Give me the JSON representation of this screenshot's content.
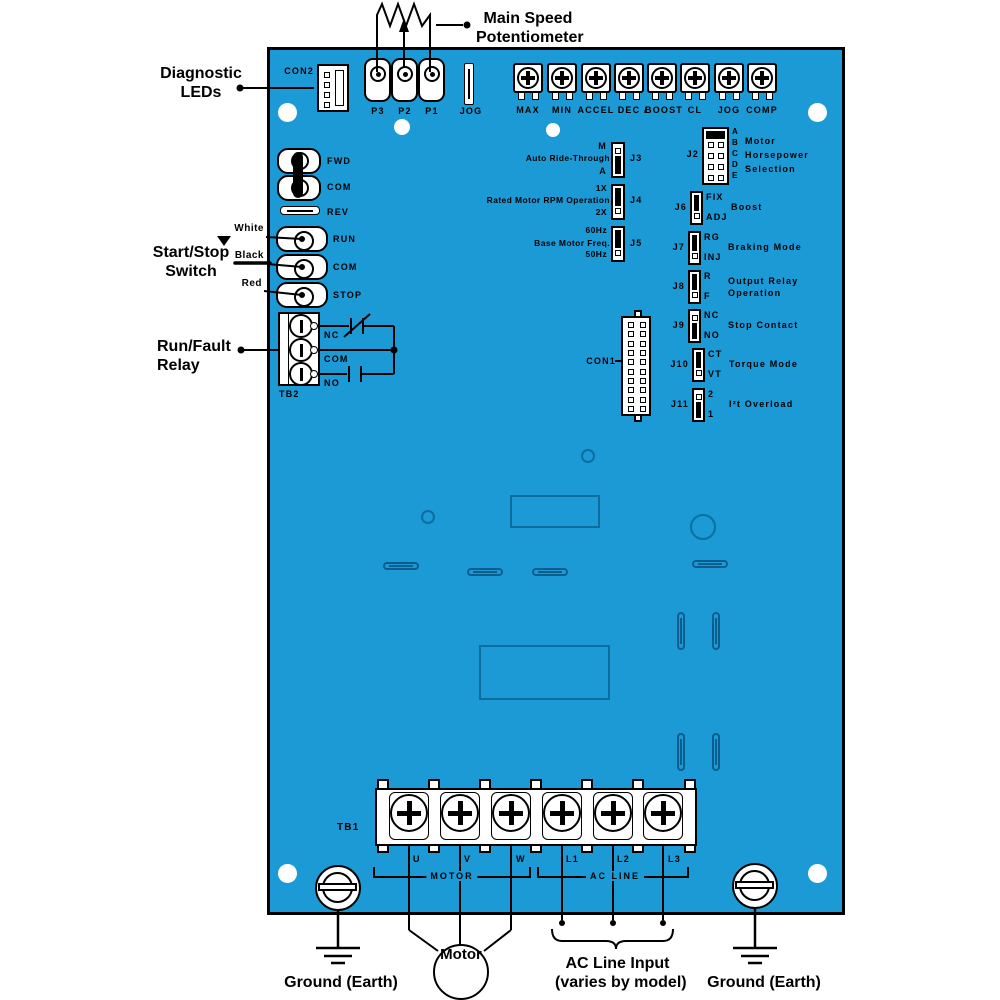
{
  "colors": {
    "board_blue": "#1b9ad6",
    "outline_blue": "#0d6e9e",
    "black": "#000000",
    "white": "#ffffff"
  },
  "callouts": {
    "main_speed_pot": {
      "line1": "Main Speed",
      "line2": "Potentiometer"
    },
    "diagnostic_leds": {
      "line1": "Diagnostic",
      "line2": "LEDs"
    },
    "start_stop_switch": {
      "line1": "Start/Stop",
      "line2": "Switch"
    },
    "run_fault_relay": {
      "line1": "Run/Fault",
      "line2": "Relay"
    },
    "ground_left": "Ground (Earth)",
    "ground_right": "Ground (Earth)",
    "motor": "Motor",
    "ac_line_input": {
      "line1": "AC Line Input",
      "line2": "(varies by model)"
    },
    "wire_white": "White",
    "wire_black": "Black",
    "wire_red": "Red"
  },
  "connectors": {
    "con1": "CON1",
    "con2": "CON2"
  },
  "speed_pot_terminals": {
    "p3": "P3",
    "p2": "P2",
    "p1": "P1",
    "jog": "JOG"
  },
  "trim_pots": {
    "labels": [
      "MAX",
      "MIN",
      "ACCEL",
      "DEC",
      "BOOST",
      "CL",
      "JOG",
      "COMP"
    ],
    "separator": "/"
  },
  "direction_switch": {
    "fwd": "FWD",
    "com": "COM",
    "rev": "REV"
  },
  "start_stop_terminals": {
    "run": "RUN",
    "com": "COM",
    "stop": "STOP"
  },
  "tb2": {
    "name": "TB2",
    "nc": "NC",
    "com": "COM",
    "no": "NO"
  },
  "jumpers": {
    "j3": {
      "id": "J3",
      "label": "Auto Ride-Through",
      "top": "M",
      "bottom": "A",
      "selected": "A"
    },
    "j4": {
      "id": "J4",
      "label": "Rated Motor RPM Operation",
      "top": "1X",
      "bottom": "2X",
      "selected": "1X"
    },
    "j5": {
      "id": "J5",
      "label": "Base Motor Freq.",
      "top": "60Hz",
      "bottom": "50Hz",
      "selected": "60Hz"
    },
    "j2": {
      "id": "J2",
      "pins": [
        "A",
        "B",
        "C",
        "D",
        "E"
      ],
      "label_line1": "Motor",
      "label_line2": "Horsepower",
      "label_line3": "Selection",
      "selected": "A"
    },
    "j6": {
      "id": "J6",
      "top": "FIX",
      "bottom": "ADJ",
      "label": "Boost",
      "selected": "FIX"
    },
    "j7": {
      "id": "J7",
      "top": "RG",
      "bottom": "INJ",
      "label": "Braking Mode",
      "selected": "RG"
    },
    "j8": {
      "id": "J8",
      "top": "R",
      "bottom": "F",
      "label_line1": "Output Relay",
      "label_line2": "Operation",
      "selected": "R"
    },
    "j9": {
      "id": "J9",
      "top": "NC",
      "bottom": "NO",
      "label": "Stop Contact",
      "selected": "NO"
    },
    "j10": {
      "id": "J10",
      "top": "CT",
      "bottom": "VT",
      "label": "Torque Mode",
      "selected": "CT"
    },
    "j11": {
      "id": "J11",
      "top": "2",
      "bottom": "1",
      "label": "I²t Overload",
      "selected": "1"
    }
  },
  "tb1": {
    "name": "TB1",
    "terminals": [
      "U",
      "V",
      "W",
      "L1",
      "L2",
      "L3"
    ],
    "group_motor": "MOTOR",
    "group_ac_line": "AC LINE"
  }
}
